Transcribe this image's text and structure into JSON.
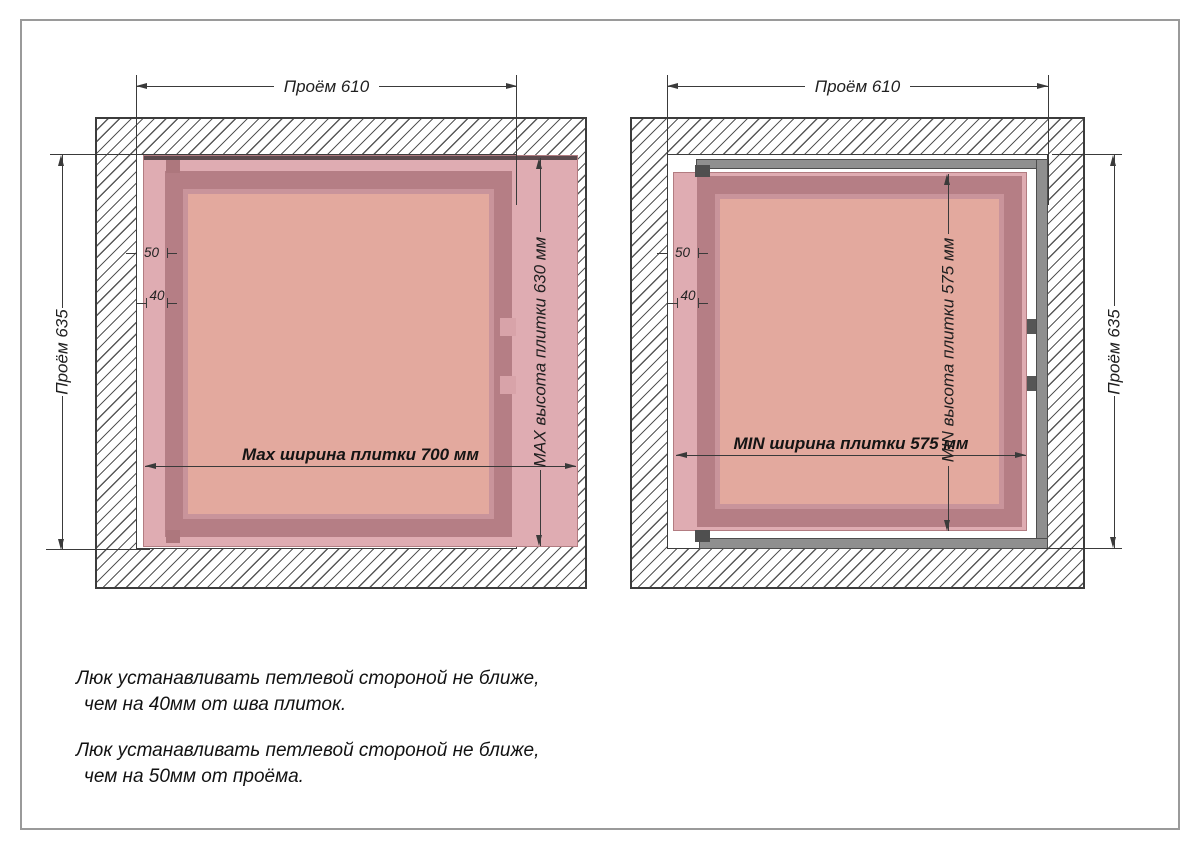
{
  "sheet": {
    "background": "#ffffff",
    "border_color": "#9a9a9a"
  },
  "colors": {
    "line": "#3a3a3a",
    "tile_pink": "#dfacb2",
    "door_frame_rose": "#b57e85",
    "door_panel_salmon": "#e3a99e",
    "metal_frame_gray": "#8f8f8f",
    "hinge_dark": "#4f4f4f"
  },
  "diagrams": [
    {
      "variant": "max",
      "opening_width_label": "Проём 610",
      "opening_height_label": "Проём 635",
      "tile_width_label": "Max ширина плитки 700 мм",
      "tile_height_label": "MAX высота плитки 630 мм",
      "offset_from_opening": "50",
      "offset_from_seam": "40"
    },
    {
      "variant": "min",
      "opening_width_label": "Проём 610",
      "opening_height_label": "Проём 635",
      "tile_width_label": "MIN ширина плитки 575 мм",
      "tile_height_label": "MIN высота плитки 575 мм",
      "offset_from_opening": "50",
      "offset_from_seam": "40"
    }
  ],
  "notes": [
    {
      "line1": "Люк устанавливать петлевой стороной не ближе,",
      "line2": "чем на 40мм от шва плиток."
    },
    {
      "line1": "Люк устанавливать петлевой стороной не ближе,",
      "line2": "чем на 50мм от проёма."
    }
  ]
}
